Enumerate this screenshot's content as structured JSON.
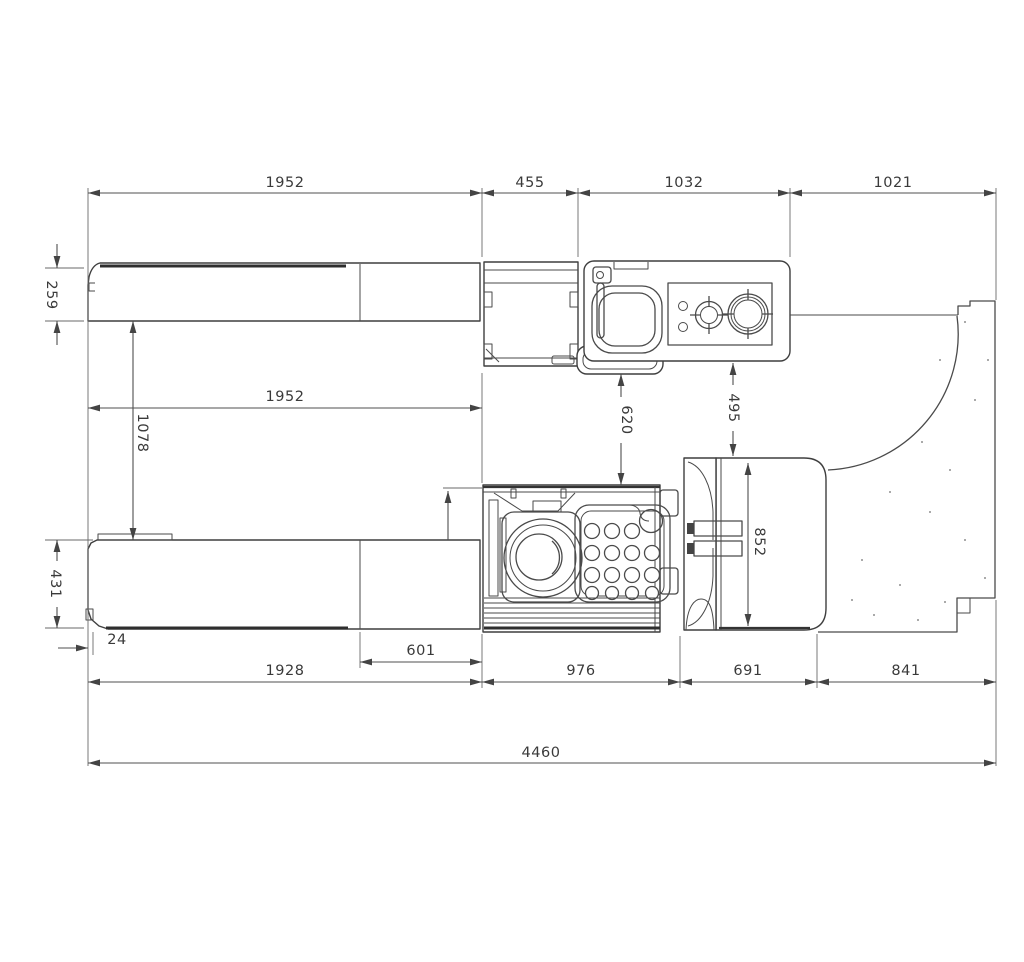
{
  "drawing": {
    "kind": "dimensioned technical drawing, machine top view",
    "colors": {
      "line": "#3f3f3f",
      "dimension": "#4f4f4f",
      "text": "#3a3a3a",
      "background": "#ffffff"
    },
    "dims": {
      "top_1952": "1952",
      "top_455": "455",
      "top_1032": "1032",
      "top_1021": "1021",
      "left_259": "259",
      "left_1078": "1078",
      "left_431": "431",
      "left_24": "24",
      "mid_1952": "1952",
      "mid_620": "620",
      "mid_495": "495",
      "right_852": "852",
      "bottom_601": "601",
      "bottom_1928": "1928",
      "bottom_976": "976",
      "bottom_691": "691",
      "bottom_841": "841",
      "total_4460": "4460"
    }
  }
}
